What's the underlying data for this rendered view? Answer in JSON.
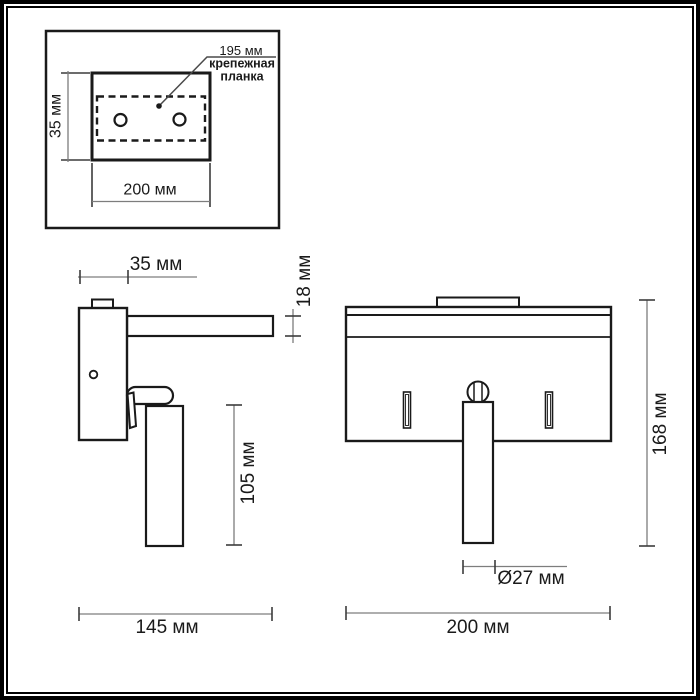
{
  "colors": {
    "outline": "#1a1a1a",
    "dim_line": "#7d7d7d",
    "tick": "#3c3c3c",
    "text": "#1a1a1a",
    "background": "#ffffff"
  },
  "inset": {
    "leader_label": "195 мм",
    "part_label_line1": "крепежная",
    "part_label_line2": "планка",
    "height_dim": "35 мм",
    "width_dim": "200 мм"
  },
  "side_view": {
    "depth_dim": "35 мм",
    "arm_height_dim": "18 мм",
    "tube_length_dim": "105 мм",
    "total_width_dim": "145 мм"
  },
  "front_view": {
    "height_dim": "168 мм",
    "tube_diameter_dim": "Ø27 мм",
    "width_dim": "200 мм"
  }
}
